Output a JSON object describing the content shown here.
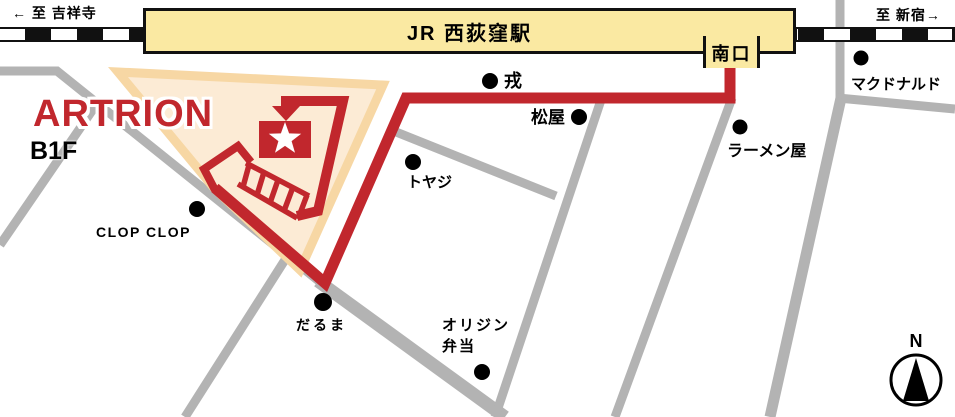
{
  "railway": {
    "direction_left": "← 至 吉祥寺",
    "direction_right": "至 新宿→",
    "station_name": "JR 西荻窪駅",
    "south_exit_label": "南口"
  },
  "venue": {
    "name": "ARTRION",
    "floor": "B1F"
  },
  "pois": [
    {
      "id": "mcdonalds",
      "name": "マクドナルド"
    },
    {
      "id": "ramen-shop",
      "name": "ラーメン屋"
    },
    {
      "id": "ebisu",
      "name": "戎"
    },
    {
      "id": "matsuya",
      "name": "松屋"
    },
    {
      "id": "toyaji",
      "name": "トヤジ"
    },
    {
      "id": "clop-clop",
      "name": "CLOP CLOP"
    },
    {
      "id": "daruma",
      "name": "だるま"
    },
    {
      "id": "origin-bento",
      "name": "オリジン弁当",
      "line1": "オリジン",
      "line2": "弁当"
    }
  ],
  "compass": {
    "north_label": "N"
  },
  "colors": {
    "route_red": "#C1272D",
    "station_yellow": "#FAE9A2",
    "building_fill": "#FCEBD5",
    "building_border": "#F7D7A4",
    "street_grey": "#B3B3B3",
    "railway_black": "#111111"
  }
}
